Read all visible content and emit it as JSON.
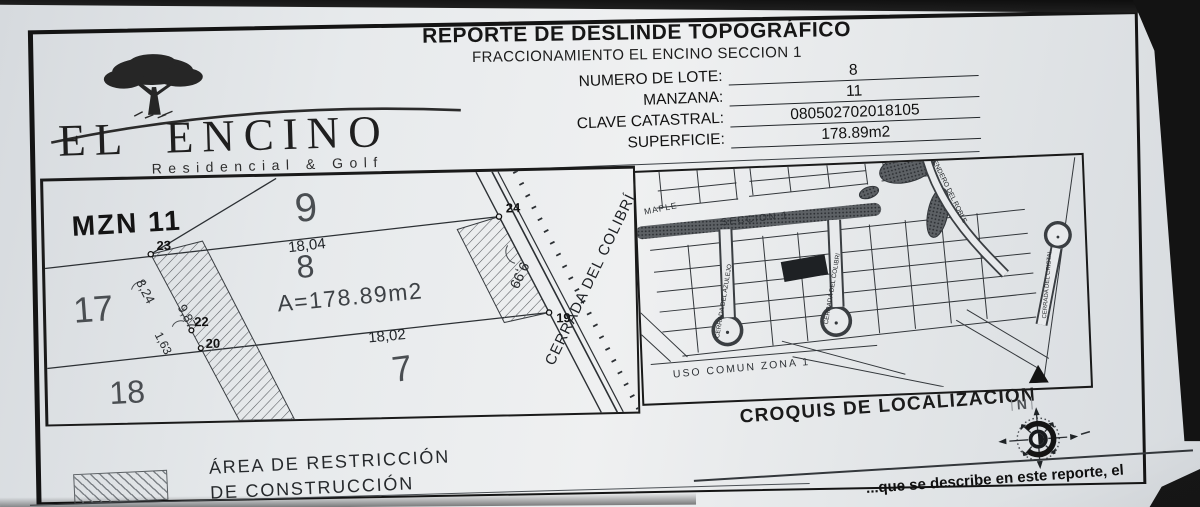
{
  "header": {
    "title": "REPORTE DE DESLINDE TOPOGRÁFICO",
    "subtitle": "FRACCIONAMIENTO EL ENCINO SECCION 1"
  },
  "logo": {
    "name": "EL ENCINO",
    "tagline": "Residencial & Golf"
  },
  "form": {
    "fields": [
      {
        "label": "NUMERO DE LOTE:",
        "value": "8"
      },
      {
        "label": "MANZANA:",
        "value": "11"
      },
      {
        "label": "CLAVE CATASTRAL:",
        "value": "080502702018105"
      },
      {
        "label": "SUPERFICIE:",
        "value": "178.89m2"
      }
    ]
  },
  "plan": {
    "block_label": "MZN 11",
    "street": "CERRADA DEL COLIBRÍ",
    "area_label": "A=178.89m2",
    "lots": {
      "lot9": "9",
      "lot17": "17",
      "lot18": "18",
      "lot8": "8",
      "lot7": "7"
    },
    "dimensions": {
      "top": "18,04",
      "bottom": "18,02",
      "left_upper": "8,24",
      "strip": "9,87",
      "left_lower": "1,63",
      "frontage": "9,99"
    },
    "points": [
      "23",
      "24",
      "22",
      "20",
      "19"
    ]
  },
  "map": {
    "caption": "CROQUIS DE LOCALIZACION",
    "streets": [
      "MAPLE",
      "SECCION 1",
      "CERRADA DEL AZULEJO",
      "CERRADA DEL COLIBRI",
      "CERRADA DEL CRISTAL",
      "SENDERO DEL ROBLE"
    ],
    "zone_label": "USO COMUN ZONA 1",
    "north_label": "N"
  },
  "legend": {
    "line1": "ÁREA DE RESTRICCIÓN",
    "line2": "DE CONSTRUCCIÓN"
  },
  "footer": {
    "partial_text": "...que se describe en este reporte, el"
  },
  "colors": {
    "paper": "#e8eaec",
    "ink": "#1c1c1c",
    "background": "#131313"
  }
}
